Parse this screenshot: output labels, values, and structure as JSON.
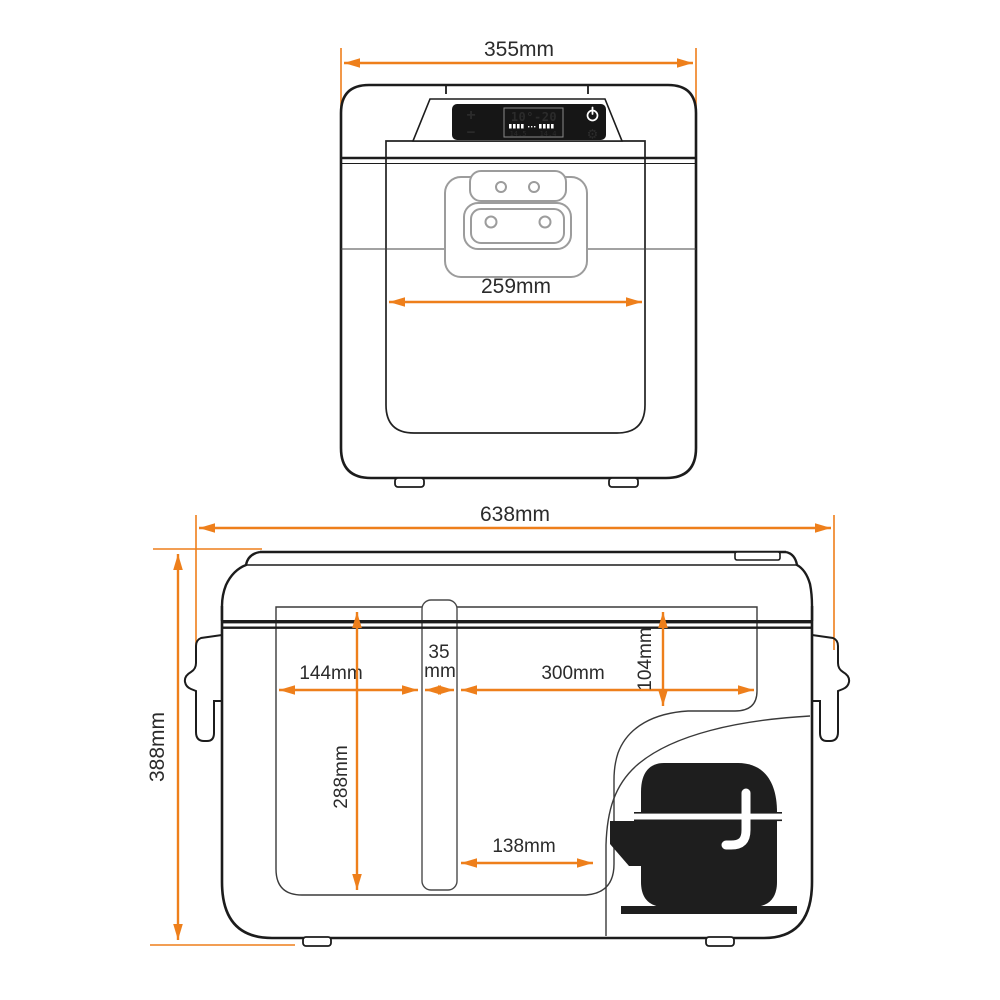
{
  "diagram": {
    "type": "product-dimension-drawing",
    "product": "portable compressor refrigerator",
    "front_view": {
      "dim_overall_width": "355mm",
      "dim_door_width": "259mm",
      "control_panel": {
        "plus": "+",
        "minus": "−",
        "temp_display": "10°-20",
        "volt_left": "14.5",
        "volt_right": "14.4",
        "gear_glyph": "⚙"
      }
    },
    "side_view": {
      "dim_overall_width": "638mm",
      "dim_overall_height": "388mm",
      "dim_left_compartment": "144mm",
      "dim_divider_line1": "35",
      "dim_divider_line2": "mm",
      "dim_right_compartment": "300mm",
      "dim_step_height": "104mm",
      "dim_inner_depth": "288mm",
      "dim_compressor_zone": "138mm"
    },
    "colors": {
      "dimension_orange": "#EE7F1B",
      "outline_black": "#1c1c1c",
      "thin_line": "#3a3a3a",
      "handle_gray": "#9c9c9c",
      "panel_black": "#161616",
      "background": "#ffffff"
    }
  }
}
